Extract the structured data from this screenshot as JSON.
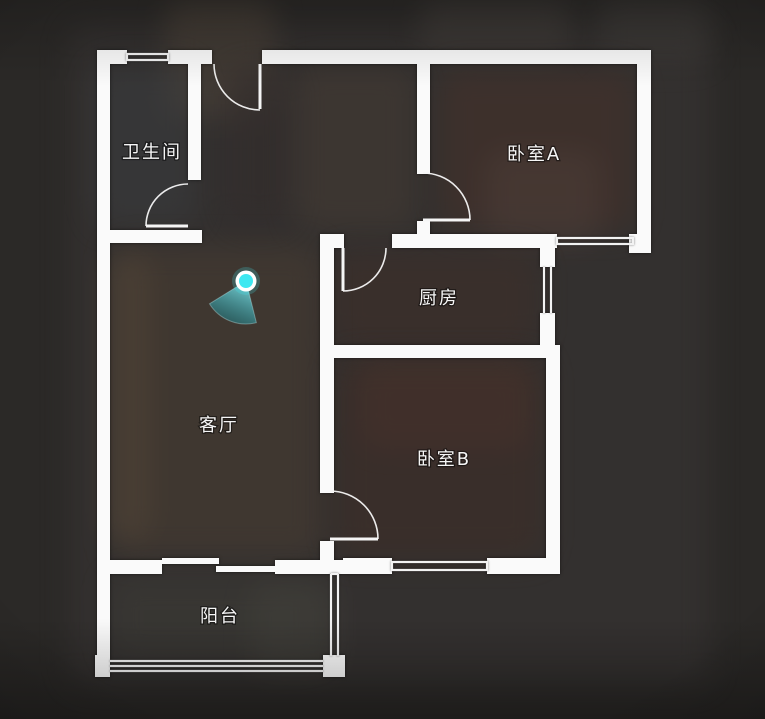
{
  "view": {
    "width": 765,
    "height": 719,
    "background": "#2b2927",
    "wall_color": "#fafafa",
    "window_line_color": "#f3f3f3",
    "door_line_color": "#f5f5f5",
    "label_color": "#f6f6f6"
  },
  "rooms": [
    {
      "id": "bathroom",
      "label": "卫生间",
      "label_x": 152,
      "label_y": 153
    },
    {
      "id": "bedroom-a",
      "label": "卧室A",
      "label_x": 534,
      "label_y": 155
    },
    {
      "id": "kitchen",
      "label": "厨房",
      "label_x": 439,
      "label_y": 299
    },
    {
      "id": "living-room",
      "label": "客厅",
      "label_x": 219,
      "label_y": 426
    },
    {
      "id": "bedroom-b",
      "label": "卧室B",
      "label_x": 444,
      "label_y": 460
    },
    {
      "id": "balcony",
      "label": "阳台",
      "label_x": 220,
      "label_y": 617
    }
  ],
  "camera": {
    "x": 246,
    "y": 281,
    "dot_color": "#3ee8f1",
    "ring_color": "#ffffff",
    "dot_radius": 7,
    "ring_radius": 10.5,
    "cone": {
      "direction_deg": 112,
      "spread_deg": 72,
      "radius": 43,
      "near_color": "rgba(130,232,238,0.9)",
      "far_color": "rgba(32,140,150,0.5)"
    }
  },
  "plan": {
    "walls": [
      [
        97,
        50,
        30,
        14
      ],
      [
        168,
        50,
        44,
        14
      ],
      [
        262,
        50,
        389,
        14
      ],
      [
        97,
        50,
        13,
        625
      ],
      [
        188,
        50,
        13,
        130
      ],
      [
        97,
        230,
        105,
        13
      ],
      [
        417,
        50,
        13,
        124
      ],
      [
        417,
        221,
        13,
        14
      ],
      [
        637,
        50,
        14,
        203
      ],
      [
        320,
        234,
        24,
        14
      ],
      [
        392,
        234,
        165,
        14
      ],
      [
        629,
        234,
        22,
        19
      ],
      [
        540,
        234,
        15,
        33
      ],
      [
        540,
        313,
        15,
        45
      ],
      [
        320,
        345,
        237,
        13
      ],
      [
        320,
        234,
        14,
        259
      ],
      [
        320,
        541,
        14,
        19
      ],
      [
        546,
        345,
        14,
        229
      ],
      [
        97,
        560,
        65,
        14
      ],
      [
        275,
        560,
        68,
        14
      ],
      [
        343,
        558,
        49,
        16
      ],
      [
        487,
        558,
        73,
        16
      ],
      [
        323,
        655,
        22,
        22
      ],
      [
        95,
        655,
        15,
        22
      ],
      [
        162,
        558,
        57,
        6
      ],
      [
        216,
        566,
        59,
        6
      ]
    ],
    "windows": [
      {
        "id": "bathroom-top",
        "lines": [
          [
            127,
            54,
            168,
            54
          ],
          [
            127,
            60,
            168,
            60
          ],
          [
            127,
            53,
            127,
            61
          ],
          [
            168,
            53,
            168,
            61
          ]
        ]
      },
      {
        "id": "bedroom-a-south",
        "lines": [
          [
            557,
            238,
            633,
            238
          ],
          [
            557,
            244,
            633,
            244
          ],
          [
            557,
            237,
            557,
            245
          ],
          [
            633,
            237,
            633,
            245
          ]
        ]
      },
      {
        "id": "kitchen-east",
        "lines": [
          [
            544,
            267,
            544,
            313
          ],
          [
            551,
            267,
            551,
            313
          ]
        ]
      },
      {
        "id": "bedroom-b-south",
        "lines": [
          [
            392,
            562,
            487,
            562
          ],
          [
            392,
            570,
            487,
            570
          ],
          [
            392,
            561,
            392,
            571
          ],
          [
            487,
            561,
            487,
            571
          ]
        ]
      },
      {
        "id": "balcony-south",
        "lines": [
          [
            110,
            661,
            323,
            661
          ],
          [
            110,
            666,
            323,
            666
          ],
          [
            110,
            671,
            323,
            671
          ]
        ]
      },
      {
        "id": "balcony-east",
        "lines": [
          [
            331,
            574,
            331,
            656
          ],
          [
            338,
            574,
            338,
            656
          ],
          [
            331,
            574,
            338,
            574
          ]
        ]
      }
    ],
    "doors": [
      {
        "id": "entry",
        "leaf": [
          260,
          64,
          260,
          109
        ],
        "arc": "M 214 64 A 46 46 0 0 0 260 110"
      },
      {
        "id": "bathroom",
        "leaf": [
          188,
          226,
          146,
          226
        ],
        "arc": "M 146 226 A 42 42 0 0 1 188 184"
      },
      {
        "id": "bedroom-a",
        "leaf": [
          423,
          220,
          470,
          220
        ],
        "arc": "M 470 220 A 47 47 0 0 0 423 173"
      },
      {
        "id": "kitchen",
        "leaf": [
          343,
          248,
          343,
          291
        ],
        "arc": "M 343 291 A 43 43 0 0 0 386 248"
      },
      {
        "id": "bedroom-b",
        "leaf": [
          330,
          539,
          378,
          539
        ],
        "arc": "M 378 539 A 48 48 0 0 0 330 491"
      }
    ]
  }
}
